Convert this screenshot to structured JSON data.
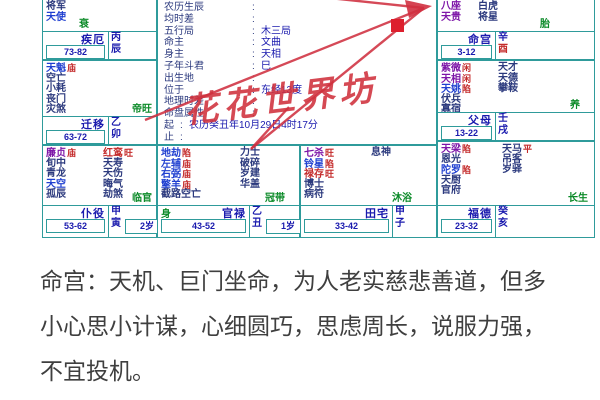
{
  "colors": {
    "grid": "#2f9b9b",
    "navy": "#1a1aae",
    "purple": "#7d16a8",
    "red": "#c42b2b",
    "blue": "#1f3fd0",
    "dark": "#2c3a7e",
    "green": "#0b8a28",
    "watermark": "#d0303c",
    "text": "#3f3f3f"
  },
  "watermark": "花花世界坊",
  "analysis": {
    "text": "命宫：天机、巨门坐命，为人老实慈悲善道，但多小心思小计谋，心细圆巧，思虑周长，说服力强，不宜投机。"
  },
  "center": {
    "colon": ":",
    "rows": [
      {
        "label": "农历生辰",
        "value": ""
      },
      {
        "label": "均时差",
        "value": ""
      },
      {
        "label": "五行局",
        "value": "木三局"
      },
      {
        "label": "命主",
        "value": "文曲"
      },
      {
        "label": "身主",
        "value": "天相"
      },
      {
        "label": "子年斗君",
        "value": "巳"
      },
      {
        "label": "出生地",
        "value": ""
      },
      {
        "label": "位于",
        "value": "东经13度"
      },
      {
        "label": "地理时差",
        "value": ""
      },
      {
        "label": "命盘属性",
        "value": ""
      },
      {
        "label": "起",
        "value": "农历癸丑年10月29日4时17分",
        "narrow": true
      },
      {
        "label": "止",
        "value": "",
        "narrow": true
      }
    ]
  },
  "palaces": [
    {
      "id": "chen",
      "name": "疾厄",
      "range": "73-82",
      "stem": "丙",
      "branch": "辰",
      "stage": "衰",
      "col1": [
        {
          "n": "将军",
          "c": "dark"
        },
        {
          "n": "天使",
          "c": "blue"
        }
      ],
      "col2": []
    },
    {
      "id": "mao",
      "name": "迁移",
      "range": "63-72",
      "stem": "乙",
      "branch": "卯",
      "stage": "帝旺",
      "col1": [
        {
          "n": "天魁",
          "c": "blue",
          "b": "庙"
        },
        {
          "n": "空亡",
          "c": "dark"
        },
        {
          "n": "小耗",
          "c": "dark"
        },
        {
          "n": "丧门",
          "c": "dark"
        },
        {
          "n": "灾煞",
          "c": "dark"
        }
      ],
      "col2": []
    },
    {
      "id": "yin",
      "name": "仆役",
      "range": "53-62",
      "stem": "甲",
      "branch": "寅",
      "age": "2岁",
      "stage": "临官",
      "col1": [
        {
          "n": "廉贞",
          "c": "purple",
          "b": "庙"
        },
        {
          "n": "旬中",
          "c": "dark"
        },
        {
          "n": "青龙",
          "c": "dark"
        },
        {
          "n": "天空",
          "c": "blue"
        },
        {
          "n": "孤辰",
          "c": "dark"
        }
      ],
      "col2": [
        {
          "n": "红鸾",
          "c": "red",
          "b": "旺"
        },
        {
          "n": "天寿",
          "c": "dark"
        },
        {
          "n": "天伤",
          "c": "dark"
        },
        {
          "n": "晦气",
          "c": "dark"
        },
        {
          "n": "劫煞",
          "c": "dark"
        }
      ]
    },
    {
      "id": "chou",
      "name": "官禄",
      "range": "43-52",
      "stem": "乙",
      "branch": "丑",
      "age": "1岁",
      "body_marker": "身",
      "stage": "冠带",
      "col1": [
        {
          "n": "地劫",
          "c": "blue",
          "b": "陷"
        },
        {
          "n": "左辅",
          "c": "blue",
          "b": "庙"
        },
        {
          "n": "右弼",
          "c": "blue",
          "b": "庙"
        },
        {
          "n": "擎羊",
          "c": "blue",
          "b": "庙"
        },
        {
          "n": "截路空亡",
          "c": "dark"
        }
      ],
      "col2": [
        {
          "n": "力士",
          "c": "dark"
        },
        {
          "n": "破碎",
          "c": "dark"
        },
        {
          "n": "岁建",
          "c": "dark"
        },
        {
          "n": "华盖",
          "c": "dark"
        }
      ]
    },
    {
      "id": "zi",
      "name": "田宅",
      "range": "33-42",
      "stem": "甲",
      "branch": "子",
      "stage": "沐浴",
      "col1": [
        {
          "n": "七杀",
          "c": "purple",
          "b": "旺"
        },
        {
          "n": "铃星",
          "c": "blue",
          "b": "陷"
        },
        {
          "n": "禄存",
          "c": "red",
          "b": "旺"
        },
        {
          "n": "博士",
          "c": "dark"
        },
        {
          "n": "病符",
          "c": "dark"
        }
      ],
      "col2": [
        {
          "n": "息神",
          "c": "dark"
        }
      ]
    },
    {
      "id": "hai",
      "name": "福德",
      "range": "23-32",
      "stem": "癸",
      "branch": "亥",
      "stage": "长生",
      "col1": [
        {
          "n": "天梁",
          "c": "purple",
          "b": "陷"
        },
        {
          "n": "恩光",
          "c": "dark"
        },
        {
          "n": "陀罗",
          "c": "blue",
          "b": "陷"
        },
        {
          "n": "天厨",
          "c": "dark"
        },
        {
          "n": "官府",
          "c": "dark"
        }
      ],
      "col2": [
        {
          "n": "天马",
          "c": "dark",
          "b": "平"
        },
        {
          "n": "吊客",
          "c": "dark"
        },
        {
          "n": "岁驿",
          "c": "dark"
        }
      ]
    },
    {
      "id": "xu",
      "name": "父母",
      "range": "13-22",
      "stem": "壬",
      "branch": "戌",
      "stage": "养",
      "col1": [
        {
          "n": "紫微",
          "c": "purple",
          "b": "闲"
        },
        {
          "n": "天相",
          "c": "purple",
          "b": "闲"
        },
        {
          "n": "天姚",
          "c": "blue",
          "b": "陷"
        },
        {
          "n": "伏兵",
          "c": "dark"
        },
        {
          "n": "寡宿",
          "c": "dark"
        }
      ],
      "col2": [
        {
          "n": "天才",
          "c": "dark"
        },
        {
          "n": "天德",
          "c": "dark"
        },
        {
          "n": "攀鞍",
          "c": "dark"
        }
      ]
    },
    {
      "id": "you",
      "name": "命宫",
      "range": "3-12",
      "stem": "辛",
      "branch": "酉",
      "branch_red": true,
      "stage": "胎",
      "col1": [
        {
          "n": "八座",
          "c": "purple"
        },
        {
          "n": "天贵",
          "c": "purple"
        }
      ],
      "col2": [
        {
          "n": "白虎",
          "c": "dark"
        },
        {
          "n": "将星",
          "c": "dark"
        }
      ]
    }
  ]
}
